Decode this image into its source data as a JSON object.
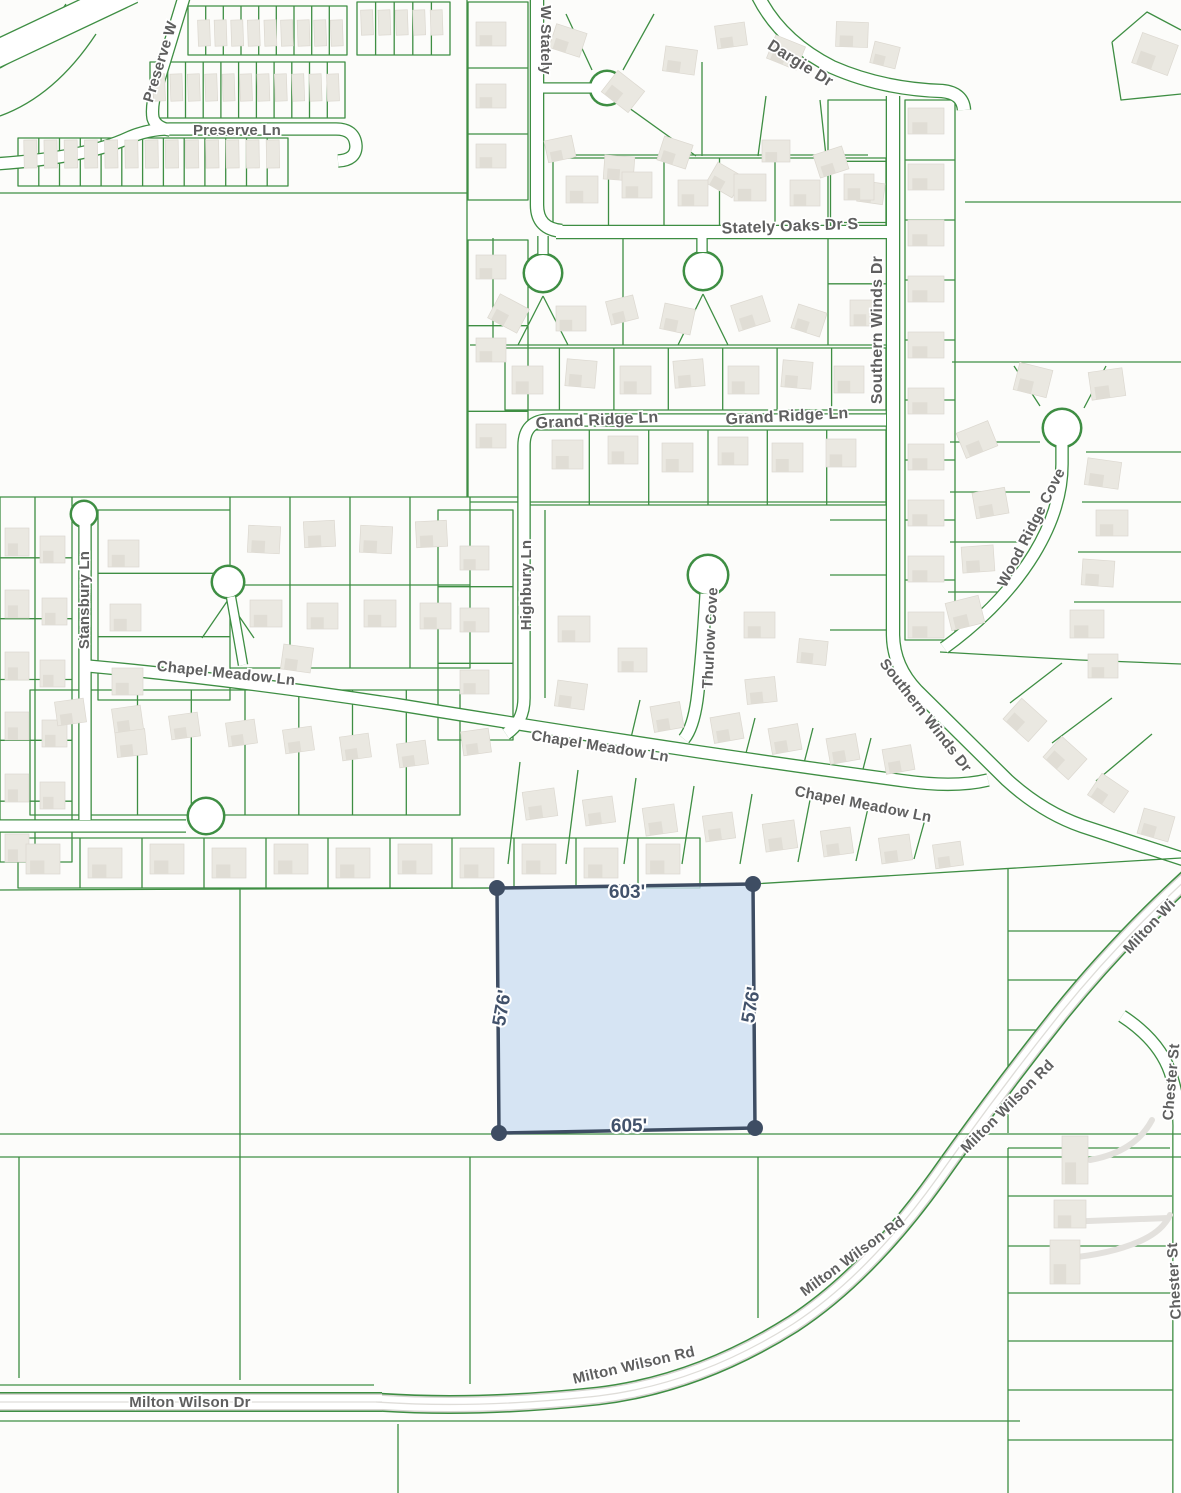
{
  "map": {
    "type": "parcel-map",
    "colors": {
      "background": "#fcfcfa",
      "parcel_line_green": "#3e8e43",
      "road_fill": "#ffffff",
      "road_casing": "#d8d6d2",
      "road_median": "#dfddd9",
      "building_fill": "#eae8e1",
      "building_shade": "#e0ddd5",
      "street_label": "#5f5f5f",
      "selected_parcel_fill": "#ccddf1",
      "selected_parcel_stroke": "#3e4d63",
      "dimension_label": "#42526b"
    },
    "street_labels": [
      {
        "id": "preserve-wy",
        "text": "Preserve W",
        "x": 161,
        "y": 62,
        "rot": -73,
        "size": 15
      },
      {
        "id": "preserve-ln",
        "text": "Preserve Ln",
        "x": 237,
        "y": 131,
        "rot": 0,
        "size": 15
      },
      {
        "id": "w-stately",
        "text": "W Stately",
        "x": 545,
        "y": 40,
        "rot": 90,
        "size": 15
      },
      {
        "id": "dargie-dr",
        "text": "Dargie Dr",
        "x": 800,
        "y": 64,
        "rot": 32,
        "size": 16
      },
      {
        "id": "stately-oaks-dr-s",
        "text": "Stately Oaks Dr S",
        "x": 790,
        "y": 227,
        "rot": -2,
        "size": 16
      },
      {
        "id": "grand-ridge-ln-1",
        "text": "Grand Ridge Ln",
        "x": 597,
        "y": 421,
        "rot": -3,
        "size": 16
      },
      {
        "id": "grand-ridge-ln-2",
        "text": "Grand Ridge Ln",
        "x": 787,
        "y": 417,
        "rot": -3,
        "size": 16
      },
      {
        "id": "southern-winds-dr-1",
        "text": "Southern Winds Dr",
        "x": 878,
        "y": 330,
        "rot": -90,
        "size": 16
      },
      {
        "id": "southern-winds-dr-2",
        "text": "Southern Winds Dr",
        "x": 925,
        "y": 716,
        "rot": 52,
        "size": 15
      },
      {
        "id": "wood-ridge-cove",
        "text": "Wood Ridge Cove",
        "x": 1032,
        "y": 528,
        "rot": -63,
        "size": 15
      },
      {
        "id": "stansbury-ln",
        "text": "Stansbury Ln",
        "x": 85,
        "y": 600,
        "rot": -90,
        "size": 15
      },
      {
        "id": "highbury-ln",
        "text": "Highbury Ln",
        "x": 527,
        "y": 585,
        "rot": -90,
        "size": 15
      },
      {
        "id": "thurlow-cove",
        "text": "Thurlow Cove",
        "x": 711,
        "y": 638,
        "rot": -87,
        "size": 15
      },
      {
        "id": "chapel-meadow-ln-1",
        "text": "Chapel Meadow Ln",
        "x": 226,
        "y": 674,
        "rot": 6,
        "size": 15
      },
      {
        "id": "chapel-meadow-ln-2",
        "text": "Chapel Meadow Ln",
        "x": 600,
        "y": 747,
        "rot": 9,
        "size": 15
      },
      {
        "id": "chapel-meadow-ln-3",
        "text": "Chapel Meadow Ln",
        "x": 863,
        "y": 805,
        "rot": 11,
        "size": 15
      },
      {
        "id": "milton-wilson-rd-1",
        "text": "Milton Wi",
        "x": 1150,
        "y": 927,
        "rot": -47,
        "size": 15
      },
      {
        "id": "milton-wilson-rd-2",
        "text": "Milton Wilson Rd",
        "x": 1008,
        "y": 1107,
        "rot": -45,
        "size": 15
      },
      {
        "id": "milton-wilson-rd-3",
        "text": "Milton Wilson Rd",
        "x": 853,
        "y": 1257,
        "rot": -36,
        "size": 15
      },
      {
        "id": "milton-wilson-rd-4",
        "text": "Milton Wilson Rd",
        "x": 634,
        "y": 1366,
        "rot": -13,
        "size": 15
      },
      {
        "id": "milton-wilson-dr",
        "text": "Milton Wilson Dr",
        "x": 190,
        "y": 1403,
        "rot": 0,
        "size": 15
      },
      {
        "id": "chester-st-1",
        "text": "Chester St",
        "x": 1172,
        "y": 1082,
        "rot": -85,
        "size": 15
      },
      {
        "id": "chester-st-2",
        "text": "Chester St",
        "x": 1175,
        "y": 1281,
        "rot": -93,
        "size": 15
      }
    ],
    "selected_parcel": {
      "points": "497,888 753,884 755,1128 499,1133",
      "vertices": [
        [
          497,
          888
        ],
        [
          753,
          884
        ],
        [
          755,
          1128
        ],
        [
          499,
          1133
        ]
      ],
      "dims": {
        "top": "603'",
        "bottom": "605'",
        "left": "576'",
        "right": "576'"
      }
    }
  }
}
